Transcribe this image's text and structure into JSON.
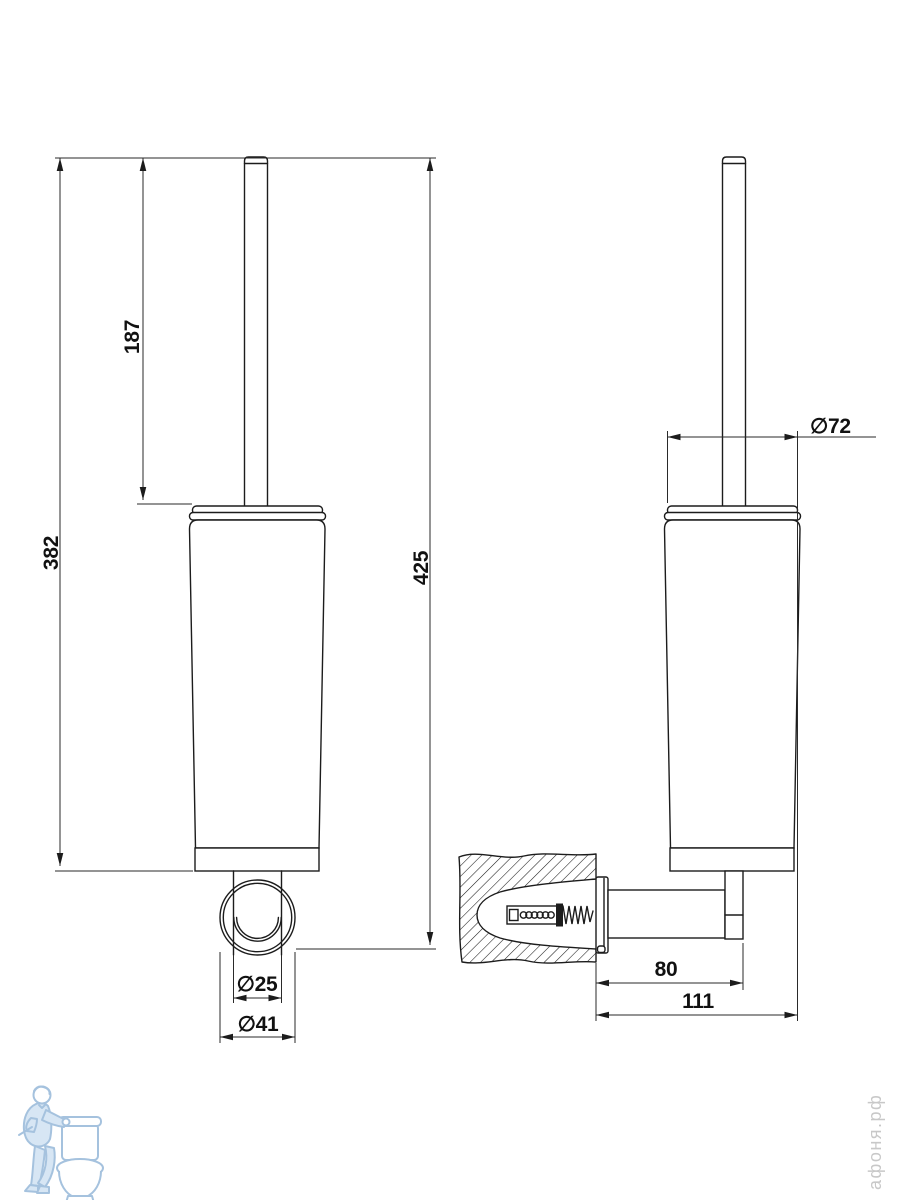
{
  "document": {
    "kind": "technical-dimension-drawing",
    "subject": "wall-mounted toilet brush holder, two orthographic views"
  },
  "views": {
    "front": {
      "name": "front view"
    },
    "side": {
      "name": "side view"
    }
  },
  "dimensions": {
    "handle_height": {
      "label": "187"
    },
    "body_bottom_height": {
      "label": "382"
    },
    "overall_height": {
      "label": "425"
    },
    "post_diameter": {
      "label": "∅25"
    },
    "rosette_diameter": {
      "label": "∅41"
    },
    "cup_diameter": {
      "label": "∅72"
    },
    "arm_projection": {
      "label": "80"
    },
    "overall_projection": {
      "label": "111"
    }
  },
  "watermark": {
    "text": "афоня.рф"
  },
  "logo": {
    "alt": "plumber leaning on toilet"
  },
  "colors": {
    "line": "#1c1c1c",
    "dimline": "#2a2a2a",
    "dimtext": "#111111",
    "wm": "#c8c8c8",
    "logo-stroke": "#a5c2de",
    "logo-fill": "#d7e6f4",
    "bg": "#ffffff"
  }
}
